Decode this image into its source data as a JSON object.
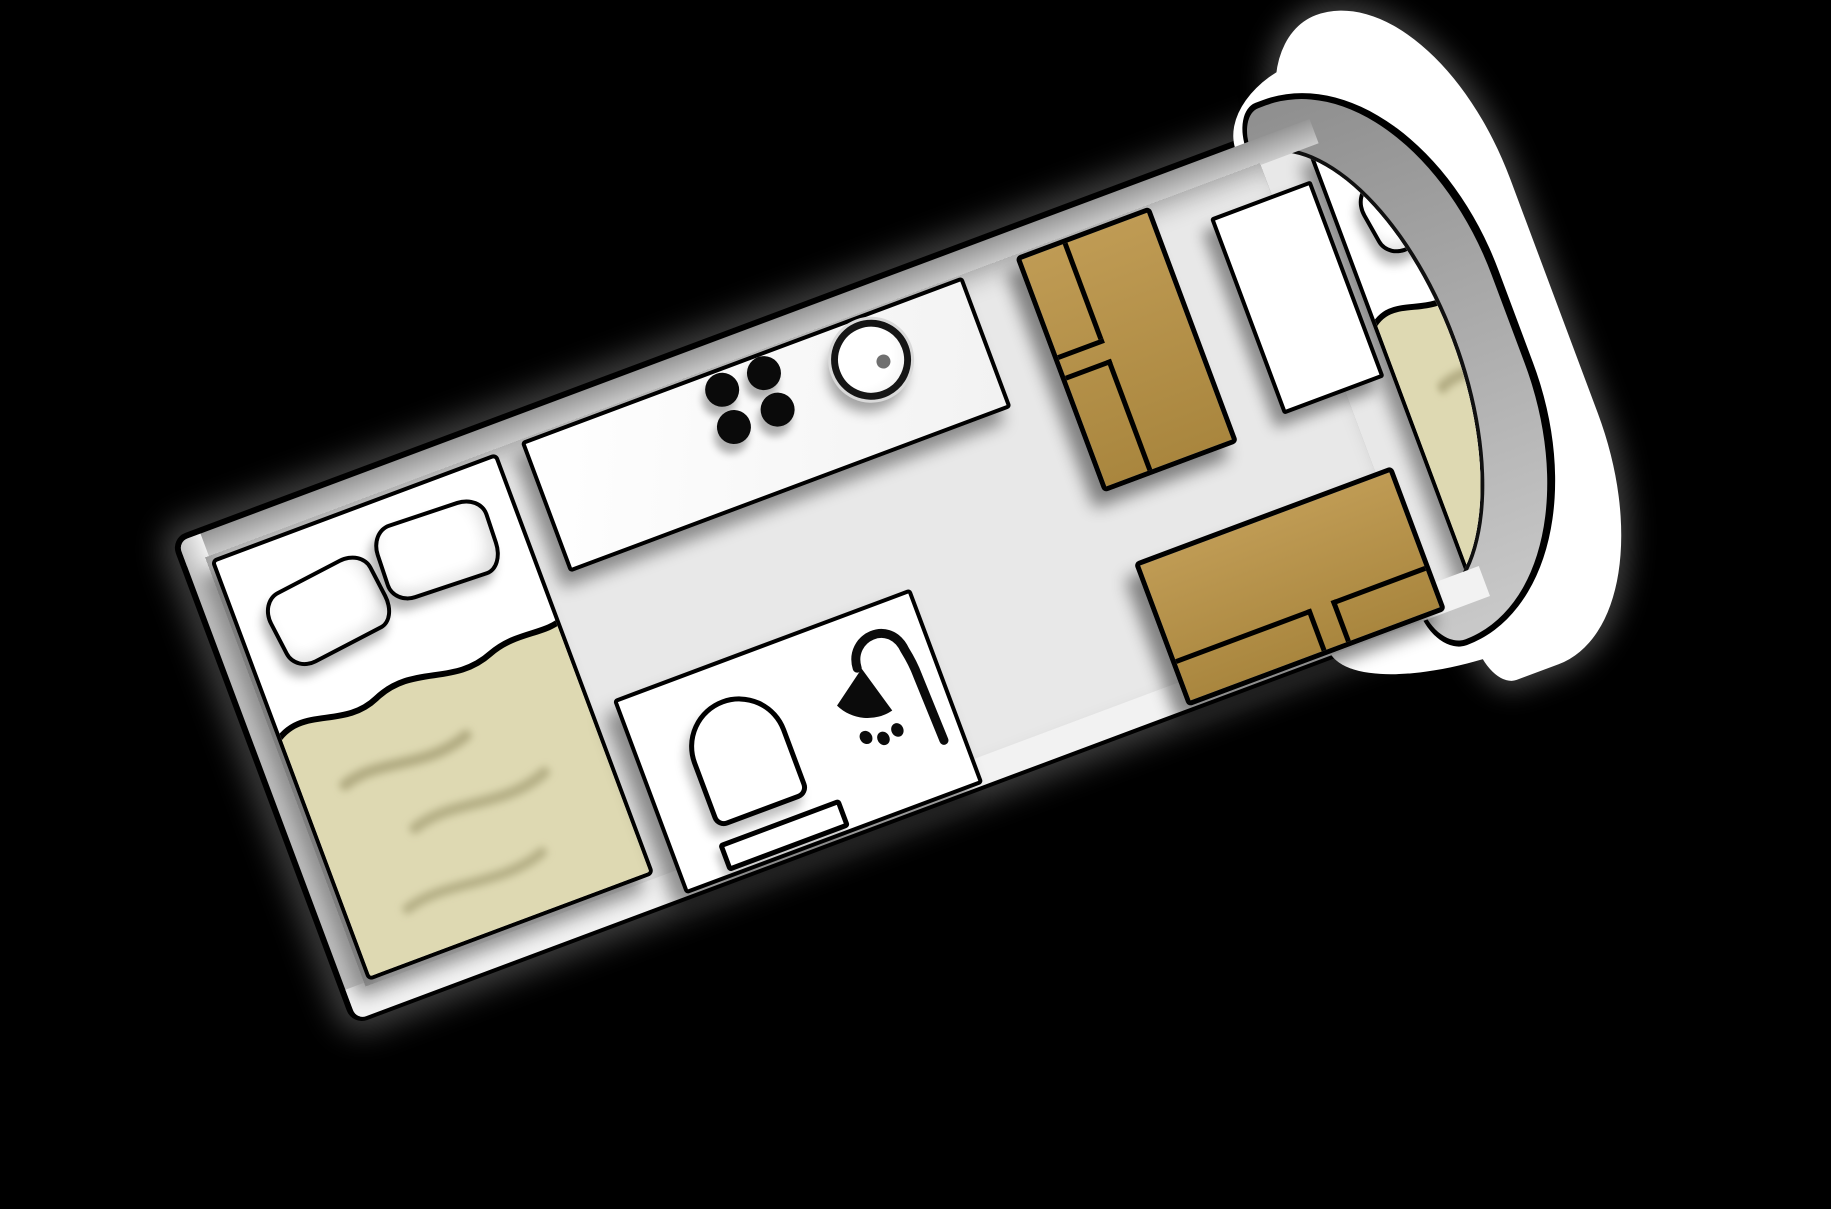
{
  "scene": {
    "type": "campervan-floor-plan-diagram",
    "description": "Top-down floor plan of a campervan rotated about -20 degrees on a black background",
    "rotation_deg": -20.5,
    "text_content": "none"
  },
  "colors": {
    "background": "#000000",
    "floor": "#e8e8e8",
    "wall": "#b3b3b3",
    "body": "#ffffff",
    "outline": "#000000",
    "mattress": "#ded9b2",
    "bench": "#b5914a",
    "drain": "#6f6f6f"
  },
  "features": {
    "vehicle": {
      "label": "Campervan floor plan"
    },
    "cab": {
      "label": "Rounded white cab nose with gray windshield band"
    },
    "rear_bed": {
      "label": "Rear double bed with two pillows and tan duvet",
      "pillows": 2
    },
    "kitchen": {
      "label": "Kitchen counter with four stove burners and round sink",
      "burners": 4,
      "sinks": 1
    },
    "bathroom": {
      "label": "Bathroom with toilet, bath mat and shower",
      "toilets": 1,
      "showers": 1
    },
    "dinette_upper": {
      "label": "Upper dinette bench with two seat cushions",
      "cushions": 2
    },
    "dinette_lower": {
      "label": "Lower dinette bench with two seat cushions",
      "cushions": 2
    },
    "wardrobe": {
      "label": "Wardrobe cabinet"
    },
    "front_bed": {
      "label": "Front double bed in cab nose with two pillows and tan duvet",
      "pillows": 2
    }
  }
}
